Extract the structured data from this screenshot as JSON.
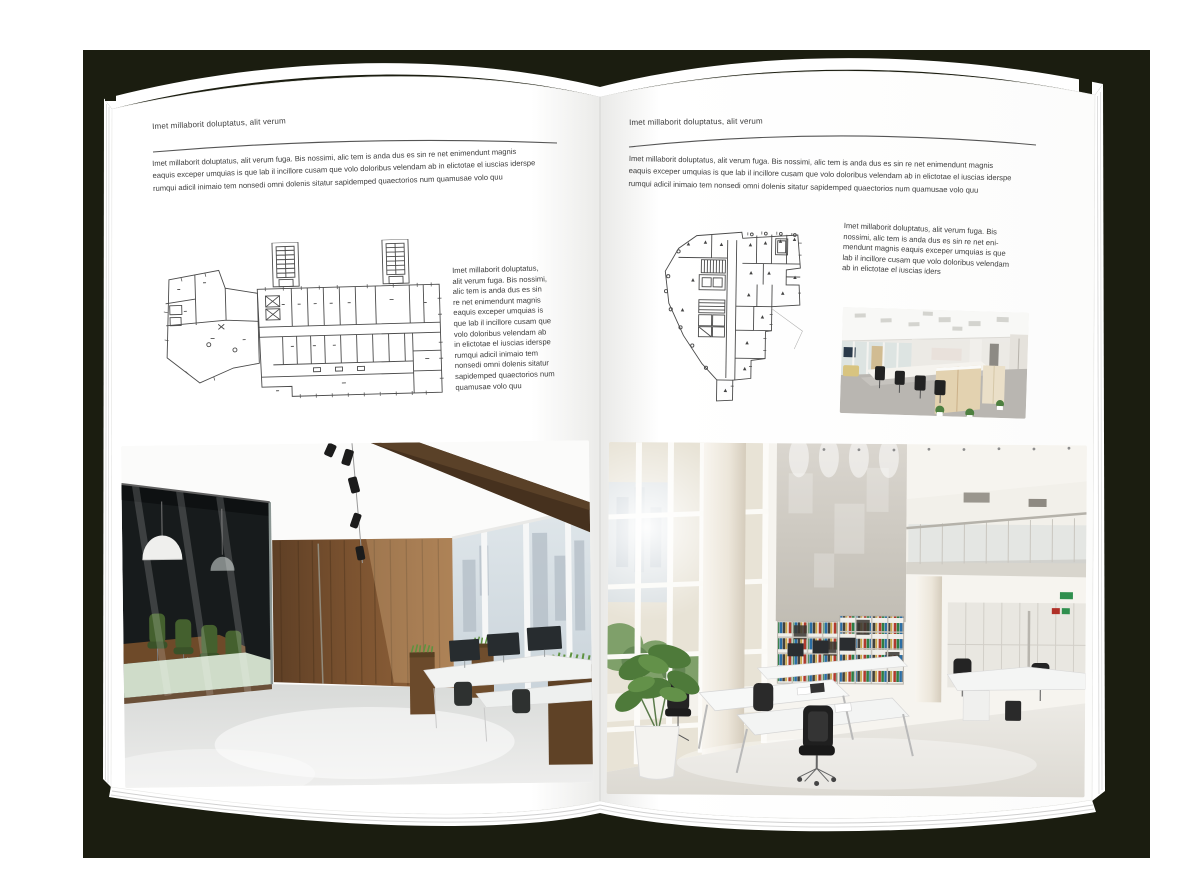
{
  "mockup": {
    "backdrop_color": "#1b1d10",
    "page_color": "#ffffff",
    "text_color": "#3d3d3d",
    "rule_color": "#555555"
  },
  "left_page": {
    "header": "Imet millaborit doluptatus, alit verum",
    "intro": "Imet millaborit doluptatus, alit verum fuga. Bis nossimi, alic tem is anda dus es sin re net enimendunt magnis\neaquis exceper umquias is que lab il incillore cusam que volo doloribus velendam ab in elictotae el iuscias iderspe\nrumqui adicil inimaio tem nonsedi omni dolenis sitatur sapidemped quaectorios num quamusae volo quu",
    "side_text": "Imet millaborit doluptatus,\nalit verum fuga. Bis nossimi,\nalic tem is anda dus es sin\nre net enimendunt magnis\neaquis exceper umquias is\nque lab il incillore cusam que\nvolo doloribus velendam ab\nin elictotae el iuscias iderspe\nrumqui adicil inimaio tem\nnonsedi omni dolenis sitatur\nsapidemped quaectorios num\nquamusae volo quu"
  },
  "right_page": {
    "header": "Imet millaborit doluptatus, alit verum",
    "intro": "Imet millaborit doluptatus, alit verum fuga. Bis nossimi, alic tem is anda dus es sin re net enimendunt magnis\neaquis exceper umquias is que lab il incillore cusam que volo doloribus velendam ab in elictotae el iuscias iderspe\nrumqui adicil inimaio tem nonsedi omni dolenis sitatur sapidemped quaectorios num quamusae volo quu",
    "side_text": "Imet millaborit doluptatus, alit verum fuga. Bis\nnossimi, alic tem is anda dus es sin re net eni-\nmendunt magnis eaquis exceper umquias is que\nlab il incillore cusam que volo doloribus velendam\nab in elictotae el iuscias iders"
  }
}
